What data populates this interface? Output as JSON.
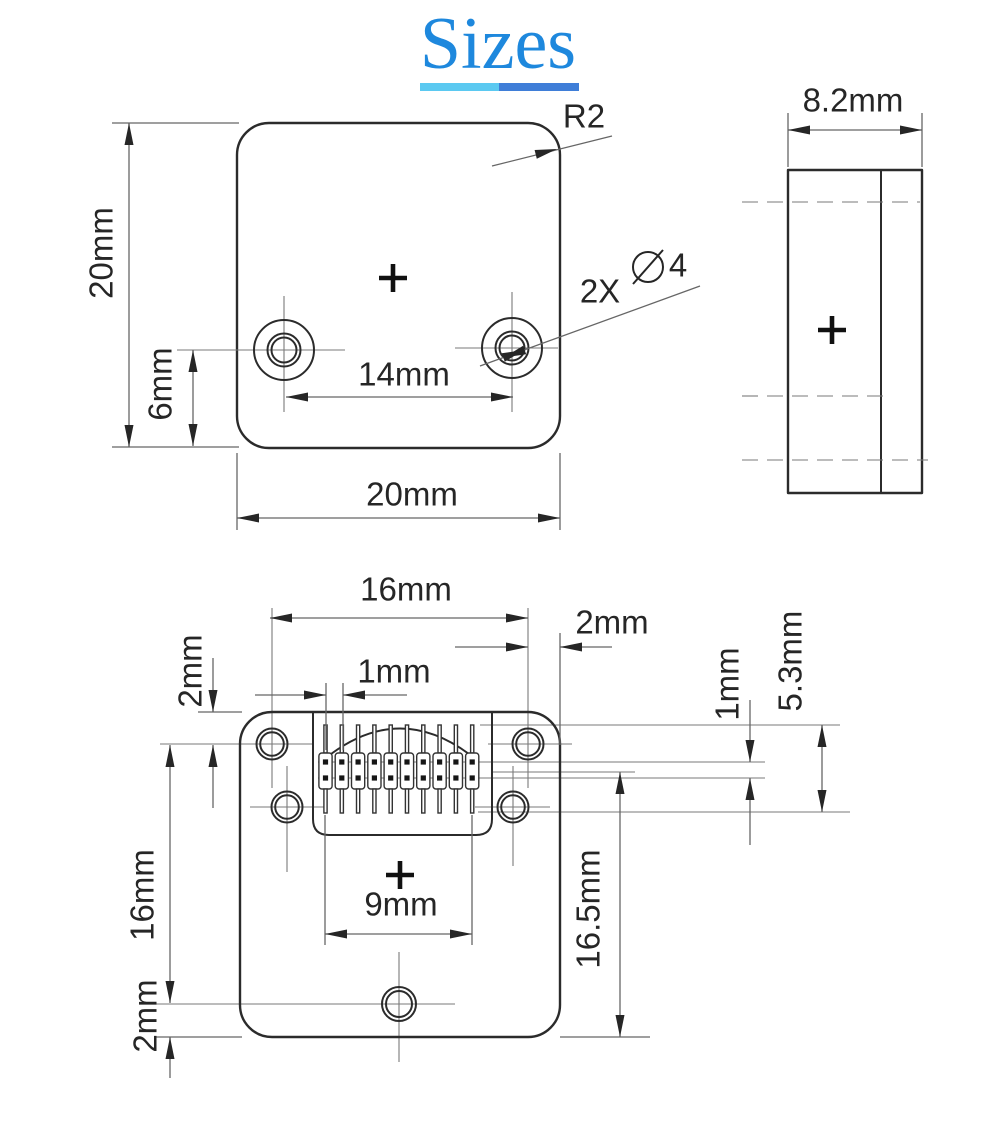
{
  "title": {
    "text": "Sizes"
  },
  "colors": {
    "title": "#1e88dd",
    "underline_left": "#5bc9f1",
    "underline_right": "#3f7ed8",
    "outline": "#2b2b2b",
    "dim": "#666666",
    "thin": "#7a7a7a",
    "text": "#262626",
    "pad": "#161616"
  },
  "connector": {
    "pin_count": 10,
    "pad_rows": 2
  },
  "dimensions_summary": {
    "front_width": "20mm",
    "front_height": "20mm",
    "corner_radius": "R2",
    "hole_spacing": "14mm",
    "hole_bottom_offset": "6mm",
    "holes": "2X ⌀4",
    "side_thickness": "8.2mm",
    "back_hole_spacing_h": "16mm",
    "back_edge_offset": "2mm",
    "back_pin_pitch": "1mm",
    "back_top_offset": "2mm",
    "back_hole_spacing_v": "16mm",
    "back_bottom_hole_offset": "2mm",
    "back_pin_span": "9mm",
    "back_connector_offset": "16.5mm",
    "back_row_pitch": "1mm",
    "back_pin_height": "5.3mm"
  },
  "annotations": [
    {
      "id": "front-height",
      "text": "20mm",
      "x": 101,
      "y": 253,
      "rot": -90
    },
    {
      "id": "front-hole-offset",
      "text": "6mm",
      "x": 160,
      "y": 384,
      "rot": -90
    },
    {
      "id": "front-hole-spacing",
      "text": "14mm",
      "x": 404,
      "y": 374,
      "rot": 0
    },
    {
      "id": "front-width",
      "text": "20mm",
      "x": 412,
      "y": 494,
      "rot": 0
    },
    {
      "id": "front-corner-radius",
      "text": "R2",
      "x": 584,
      "y": 116,
      "rot": 0
    },
    {
      "id": "front-hole-count",
      "text": "2X",
      "x": 600,
      "y": 291,
      "rot": 0
    },
    {
      "id": "front-hole-diameter",
      "text": "4",
      "x": 678,
      "y": 265,
      "rot": 0
    },
    {
      "id": "side-thickness",
      "text": "8.2mm",
      "x": 853,
      "y": 100,
      "rot": 0
    },
    {
      "id": "back-hole-spacing-h",
      "text": "16mm",
      "x": 406,
      "y": 589,
      "rot": 0
    },
    {
      "id": "back-edge-offset",
      "text": "2mm",
      "x": 612,
      "y": 622,
      "rot": 0
    },
    {
      "id": "back-pin-pitch",
      "text": "1mm",
      "x": 394,
      "y": 671,
      "rot": 0
    },
    {
      "id": "back-top-offset",
      "text": "2mm",
      "x": 190,
      "y": 671,
      "rot": -90
    },
    {
      "id": "back-hole-spacing-v",
      "text": "16mm",
      "x": 142,
      "y": 895,
      "rot": -90
    },
    {
      "id": "back-bottom-hole-offset",
      "text": "2mm",
      "x": 145,
      "y": 1016,
      "rot": -90
    },
    {
      "id": "back-pin-span",
      "text": "9mm",
      "x": 401,
      "y": 904,
      "rot": 0
    },
    {
      "id": "back-connector-offset",
      "text": "16.5mm",
      "x": 588,
      "y": 909,
      "rot": -90
    },
    {
      "id": "back-row-pitch",
      "text": "1mm",
      "x": 727,
      "y": 684,
      "rot": -90
    },
    {
      "id": "back-pin-height",
      "text": "5.3mm",
      "x": 790,
      "y": 661,
      "rot": -90
    }
  ]
}
